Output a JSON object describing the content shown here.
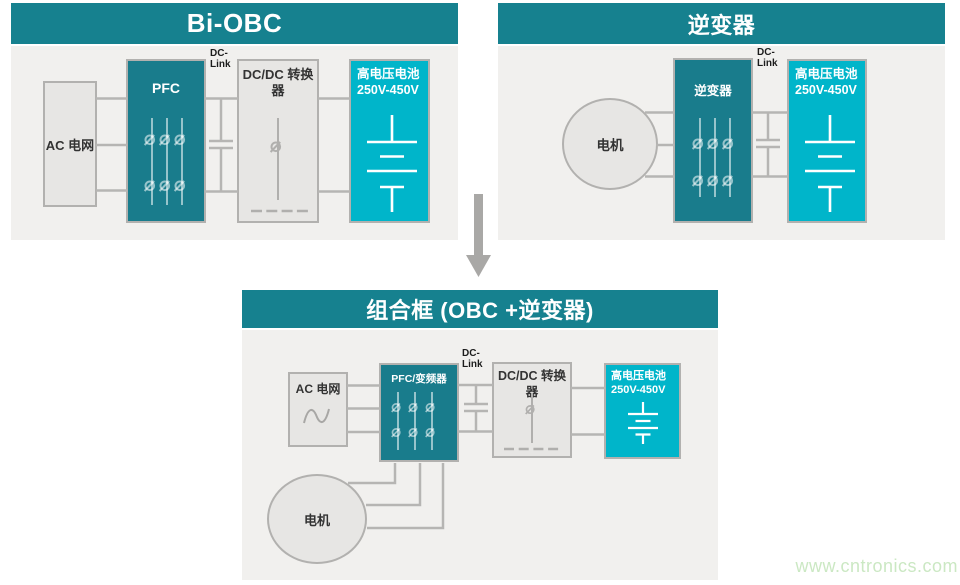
{
  "colors": {
    "header_teal": "#16818F",
    "box_teal": "#197C8C",
    "battery_cyan": "#00B5CA",
    "panel_bg": "#F1F0EE",
    "box_bg": "#E7E6E4",
    "border_gray": "#B2B1AF",
    "line_gray": "#B6B5B3",
    "arrow_gray": "#A9A8A6",
    "text_dark": "#333333",
    "watermark_green": "#CBE8C3"
  },
  "panels": {
    "bi_obc": {
      "title": "Bi-OBC",
      "ac_grid_label": "AC 电网",
      "pfc_label": "PFC",
      "dc_link_line1": "DC-",
      "dc_link_line2": "Link",
      "dcdc_line1": "DC/DC 转换",
      "dcdc_line2": "器",
      "battery_line1": "高电压电池",
      "battery_line2": "250V-450V"
    },
    "inverter": {
      "title": "逆变器",
      "motor_label": "电机",
      "inverter_label": "逆变器",
      "dc_link_line1": "DC-",
      "dc_link_line2": "Link",
      "battery_line1": "高电压电池",
      "battery_line2": "250V-450V"
    },
    "combined": {
      "title": "组合框 (OBC +逆变器)",
      "ac_grid_label": "AC 电网",
      "pfc_inverter_label": "PFC/变频器",
      "dc_link_line1": "DC-",
      "dc_link_line2": "Link",
      "dcdc_line1": "DC/DC 转换",
      "dcdc_line2": "器",
      "battery_line1": "高电压电池",
      "battery_line2": "250V-450V",
      "motor_label": "电机"
    }
  },
  "watermark": "www.cntronics.com"
}
